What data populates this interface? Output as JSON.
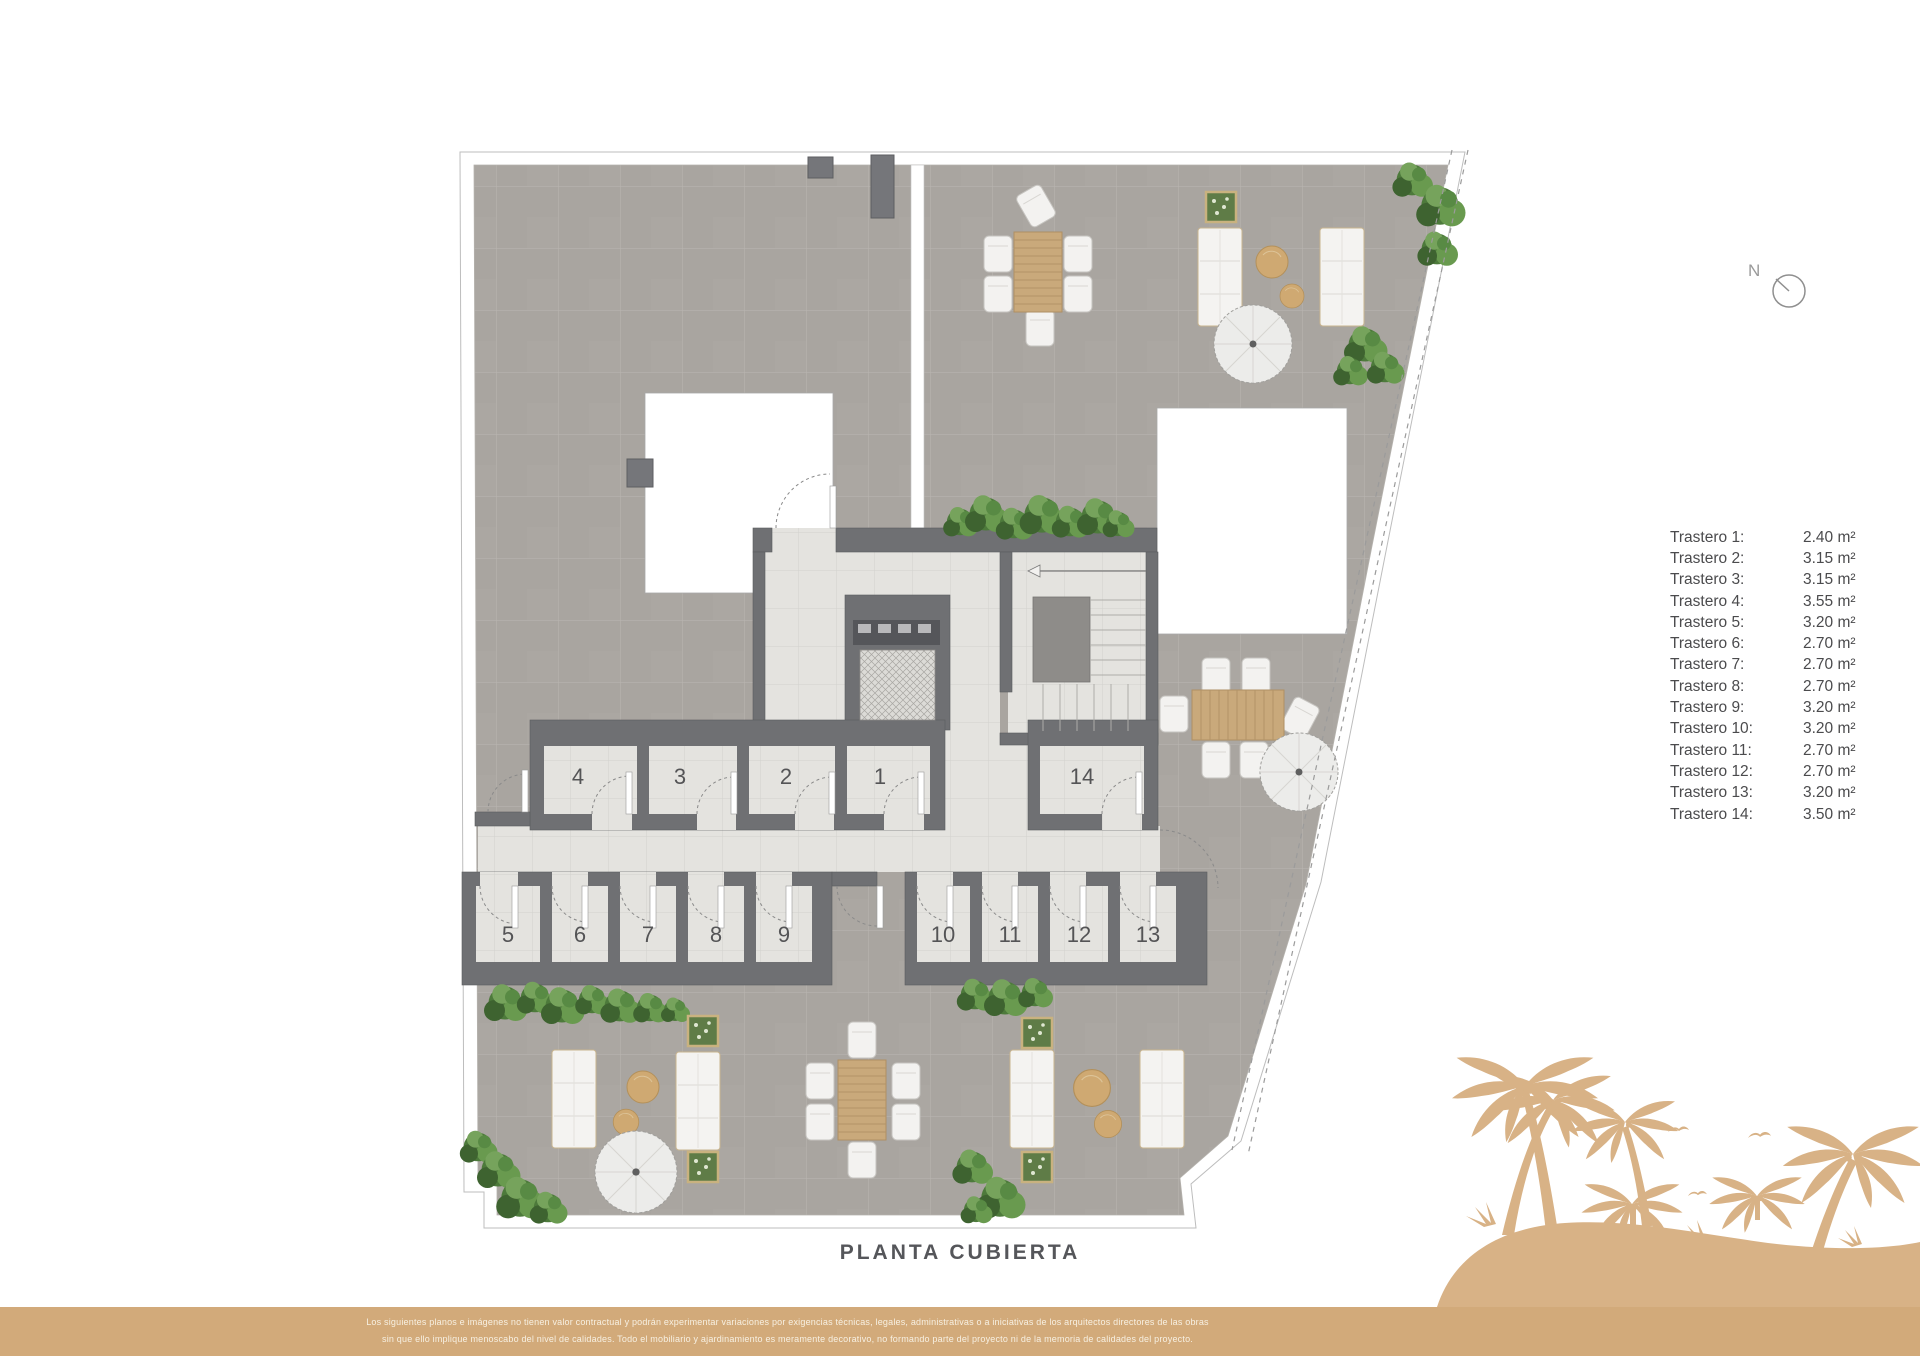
{
  "plan": {
    "title": "PLANTA CUBIERTA",
    "rooms": [
      {
        "number": "1"
      },
      {
        "number": "2"
      },
      {
        "number": "3"
      },
      {
        "number": "4"
      },
      {
        "number": "5"
      },
      {
        "number": "6"
      },
      {
        "number": "7"
      },
      {
        "number": "8"
      },
      {
        "number": "9"
      },
      {
        "number": "10"
      },
      {
        "number": "11"
      },
      {
        "number": "12"
      },
      {
        "number": "13"
      },
      {
        "number": "14"
      }
    ]
  },
  "legend": {
    "items": [
      {
        "label": "Trastero 1:",
        "area": "2.40 m²"
      },
      {
        "label": "Trastero 2:",
        "area": "3.15 m²"
      },
      {
        "label": "Trastero 3:",
        "area": "3.15 m²"
      },
      {
        "label": "Trastero 4:",
        "area": "3.55 m²"
      },
      {
        "label": "Trastero 5:",
        "area": "3.20 m²"
      },
      {
        "label": "Trastero 6:",
        "area": "2.70 m²"
      },
      {
        "label": "Trastero 7:",
        "area": "2.70 m²"
      },
      {
        "label": "Trastero 8:",
        "area": "2.70 m²"
      },
      {
        "label": "Trastero 9:",
        "area": "3.20 m²"
      },
      {
        "label": "Trastero 10:",
        "area": "3.20 m²"
      },
      {
        "label": "Trastero 11:",
        "area": "2.70 m²"
      },
      {
        "label": "Trastero 12:",
        "area": "2.70 m²"
      },
      {
        "label": "Trastero 13:",
        "area": "3.20 m²"
      },
      {
        "label": "Trastero 14:",
        "area": "3.50 m²"
      }
    ]
  },
  "compass": {
    "label": "N"
  },
  "footer": {
    "line1": "Los siguientes planos e imágenes no tienen valor contractual y podrán experimentar variaciones por exigencias técnicas, legales, administrativas o a iniciativas de los arquitectos directores de las obras",
    "line2": "sin que ello implique menoscabo del nivel de calidades. Todo el mobiliario y ajardinamiento es meramente decorativo, no formando parte del proyecto ni de la memoria de calidades del proyecto."
  },
  "colors": {
    "footer_tan": "#d2aa7a",
    "palm_tan": "#d8b286",
    "wall_gray": "#6f7073",
    "terrace_tile": "#a9a5a0",
    "light_tile": "#e4e3df",
    "legend_text": "#4b4b4d"
  }
}
